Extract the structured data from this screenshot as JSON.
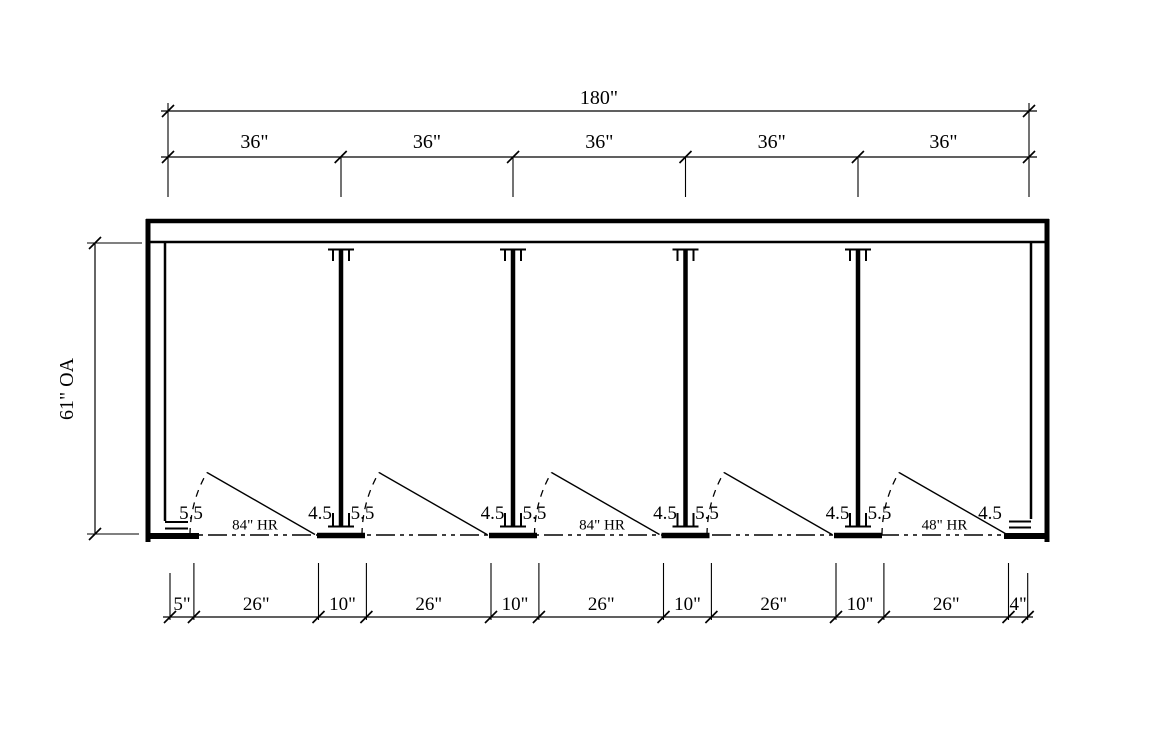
{
  "colors": {
    "ink": "#000000",
    "background": "#ffffff"
  },
  "dimensions": {
    "overall_width": "180\"",
    "stall_widths": [
      "36\"",
      "36\"",
      "36\"",
      "36\"",
      "36\""
    ],
    "overall_depth": "61\" OA",
    "bottom_segments": [
      "5\"",
      "26\"",
      "10\"",
      "26\"",
      "10\"",
      "26\"",
      "10\"",
      "26\"",
      "10\"",
      "26\"",
      "4\""
    ],
    "hinge_clearances": [
      "5.5",
      "5.5",
      "5.5",
      "5.5",
      "5.5"
    ],
    "latch_clearances": [
      "4.5",
      "4.5",
      "4.5",
      "4.5",
      "4.5"
    ],
    "headrail_labels": [
      "84\" HR",
      "84\" HR",
      "48\" HR"
    ]
  }
}
